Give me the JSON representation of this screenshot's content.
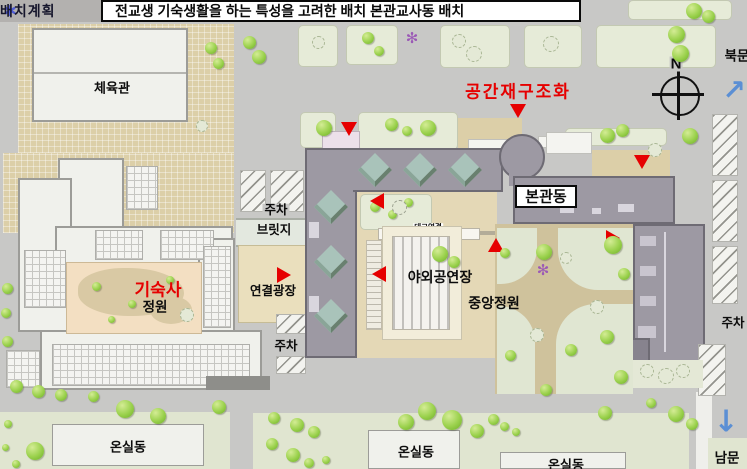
{
  "header": {
    "star_icon": "✱",
    "section_label": "배치계획",
    "title": "전교생 기숙생활을 하는 특성을 고려한 배치 본관교사동 배치"
  },
  "plan": {
    "gym": "체육관",
    "dormitory": "기숙사",
    "dormitory_garden": "정원",
    "parking": "주차",
    "bridge": "브릿지",
    "link_plaza": "연결광장",
    "outdoor_stage": "야외공연장",
    "central_garden": "중앙정원",
    "deck_link": "데크연결",
    "main_building": "본관동",
    "space_restructuring": "공간재구조화",
    "greenhouse": "온실동",
    "north_gate": "북문",
    "south_gate": "남문",
    "compass_north": "N",
    "north_arrow": "↗",
    "south_arrow": "↓",
    "flower_icon": "✻"
  },
  "colors": {
    "marker_red": "#e60000",
    "building_gray": "#9d99a3",
    "skylight_teal": "#a9c3ba",
    "courtyard_beige": "#f3dfc2",
    "path_tan": "#dccfa8",
    "tree_green": "#9ad14c",
    "arrow_blue": "#5b8fd4",
    "header_star_blue": "#4f5cd6"
  }
}
